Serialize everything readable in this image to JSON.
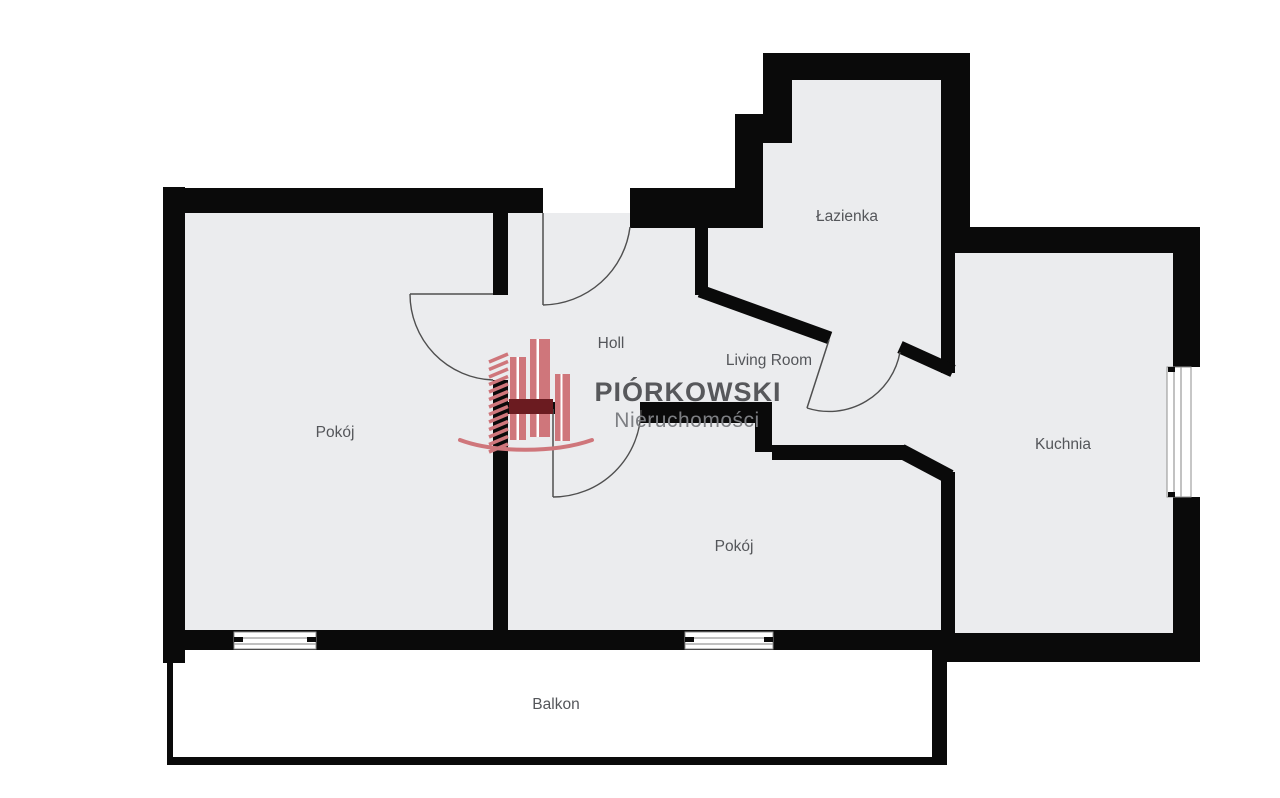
{
  "plan": {
    "type": "apartment-floor-plan",
    "rooms": [
      {
        "id": "pokoj-1",
        "label": "Pokój"
      },
      {
        "id": "holl",
        "label": "Holl"
      },
      {
        "id": "living-room",
        "label": "Living Room"
      },
      {
        "id": "lazienka",
        "label": "Łazienka"
      },
      {
        "id": "kuchnia",
        "label": "Kuchnia"
      },
      {
        "id": "pokoj-2",
        "label": "Pokój"
      },
      {
        "id": "balkon",
        "label": "Balkon"
      }
    ]
  },
  "logo": {
    "brand": "PIÓRKOWSKI",
    "subtitle": "Nieruchomości"
  },
  "colors": {
    "background": "#FFFFFF",
    "floor": "#EBECEE",
    "wall": "#0A0A0A",
    "label_text": "#54565A",
    "door_line": "#4F4F4F",
    "logo_rose": "#CF767B",
    "logo_dark_red": "#6B1B20",
    "logo_brand_text": "#57585B",
    "logo_subtitle_text": "#7D7F83"
  }
}
